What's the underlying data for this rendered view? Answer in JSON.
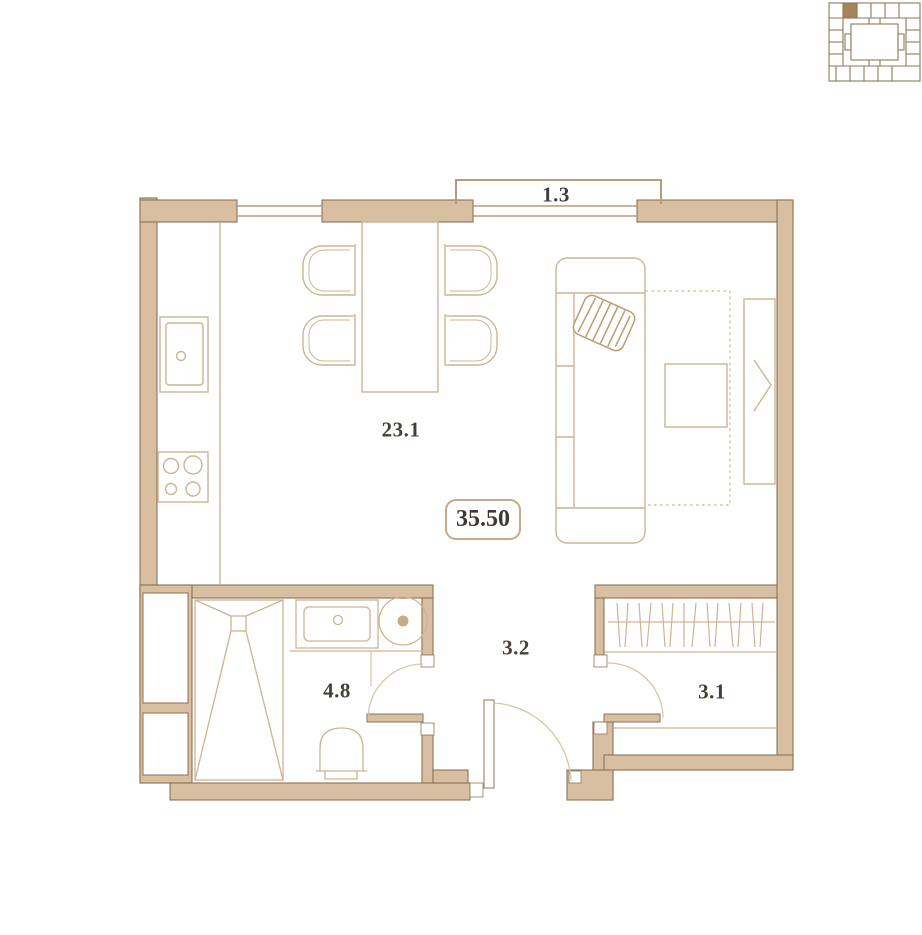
{
  "floor_plan": {
    "total_area": {
      "value": "35.50"
    },
    "rooms": [
      {
        "name": "living-kitchen",
        "area": "23.1"
      },
      {
        "name": "bathroom",
        "area": "4.8"
      },
      {
        "name": "hallway",
        "area": "3.2"
      },
      {
        "name": "wardrobe",
        "area": "3.1"
      },
      {
        "name": "balcony",
        "area": "1.3"
      }
    ],
    "fixtures": [
      "kitchen-sink-icon",
      "stove-4-burner-icon",
      "dining-table-icon",
      "chair-icon",
      "sofa-icon",
      "striped-pillow-icon",
      "rug-icon",
      "coffee-table-icon",
      "tv-unit-icon",
      "shower-icon",
      "vanity-sink-icon",
      "washing-machine-icon",
      "toilet-icon",
      "closet-hangers-icon",
      "duct-shaft-icon"
    ],
    "doors": [
      "entrance-door",
      "bathroom-door",
      "wardrobe-door"
    ],
    "windows": [
      "window-left",
      "window-balcony"
    ],
    "key_plan": {
      "icon": "building-key-plan-icon",
      "highlighted_unit": true
    }
  },
  "colors": {
    "wall_fill": "#d9bfa1",
    "wall_line": "#8a7356",
    "furniture_line": "#cdb493",
    "window_line": "#b49c7d",
    "text": "#453f37",
    "key_plan_unit": "#a5835b"
  }
}
